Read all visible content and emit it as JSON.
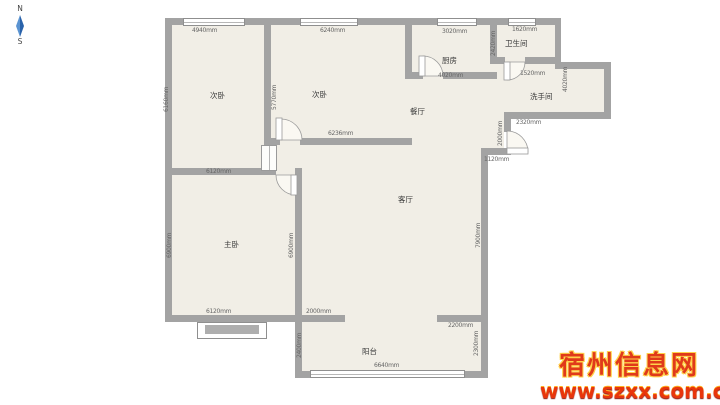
{
  "compass": {
    "north": "N",
    "south": "S"
  },
  "rooms": {
    "bedroom_left": "次卧",
    "bedroom_mid": "次卧",
    "kitchen": "厨房",
    "bathroom": "卫生间",
    "washroom": "洗手间",
    "dining": "餐厅",
    "living": "客厅",
    "master": "主卧",
    "balcony": "阳台"
  },
  "dims": {
    "bed1_window": "4940mm",
    "bed2_window": "6240mm",
    "kitchen_window": "3020mm",
    "bath_window": "1620mm",
    "bed1_height": "6160mm",
    "bed2_height": "5770mm",
    "bath_height": "2420mm",
    "right_side": "4020mm",
    "kitchen_width": "4020mm",
    "bath_door": "1520mm",
    "bed2_width": "6236mm",
    "master_width_top": "6120mm",
    "master_height_left": "6900mm",
    "master_height_right": "6900mm",
    "wash_bottom": "2320mm",
    "entry_wall": "2000mm",
    "entry_step": "1120mm",
    "living_height": "7900mm",
    "master_width_bottom": "6120mm",
    "living_bottom_left": "2000mm",
    "living_bottom_right": "2200mm",
    "balcony_left": "2400mm",
    "balcony_right": "2300mm",
    "balcony_window": "6640mm"
  },
  "watermark": {
    "site_name": "宿州信息网",
    "site_url": "www.szxx.com.cn"
  },
  "colors": {
    "wall": "#a3a3a3",
    "floor": "#f1eee6",
    "watermark_red": "#e03a1a",
    "watermark_yellow": "#ffd24a",
    "compass_blue": "#2e6db4"
  }
}
